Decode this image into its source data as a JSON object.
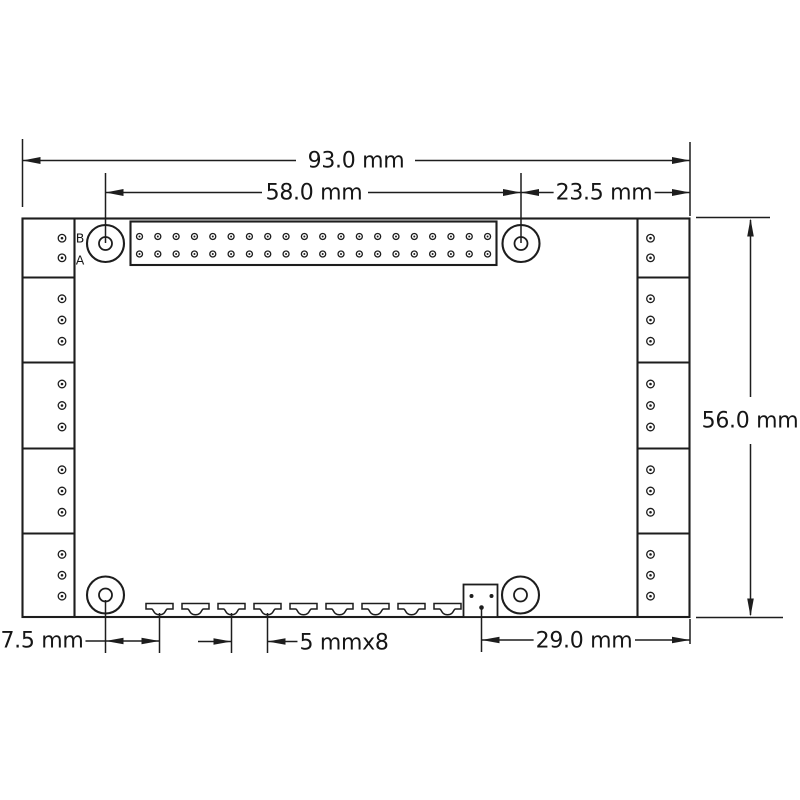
{
  "drawing": {
    "dimensions": {
      "board_width": "93.0 mm",
      "header_offset": "58.0 mm",
      "hole_to_right_edge": "23.5 mm",
      "board_height": "56.0 mm",
      "hole_to_first_tab": "7.5 mm",
      "tab_pitch": "5 mmx8",
      "connector_to_right_edge": "29.0 mm"
    },
    "labels": {
      "pin_row_b": "B",
      "pin_row_a": "A"
    },
    "colors": {
      "line": "#1d1d1d",
      "background": "#ffffff",
      "text": "#161616"
    },
    "board": {
      "gpio_header": {
        "rows": 2,
        "cols": 20
      },
      "side_terminal_blocks_per_side": 5,
      "side_block_pin_counts": [
        2,
        3,
        3,
        3,
        3
      ],
      "bottom_tab_count": 9,
      "mounting_hole_count": 4,
      "bottom_connector_pad_count": 3
    }
  }
}
